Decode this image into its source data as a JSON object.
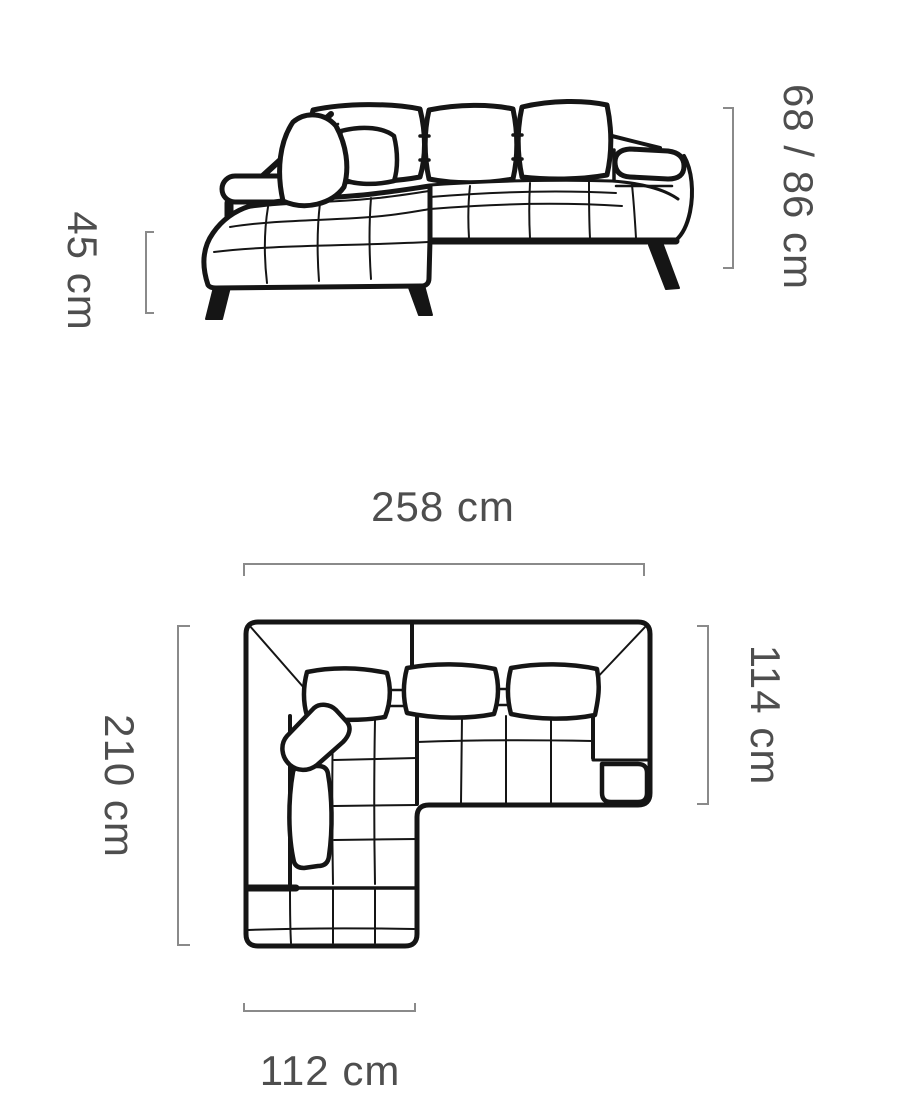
{
  "diagram": {
    "front_view": {
      "dim_height": "68 / 86 cm",
      "dim_seat_height": "45 cm"
    },
    "top_view": {
      "dim_width": "258 cm",
      "dim_depth": "210 cm",
      "dim_right_depth": "114 cm",
      "dim_chaise_width": "112 cm"
    },
    "colors": {
      "line": "#151515",
      "bracket": "#8a8a8a",
      "label": "#4e4e4e",
      "background": "#ffffff"
    }
  }
}
